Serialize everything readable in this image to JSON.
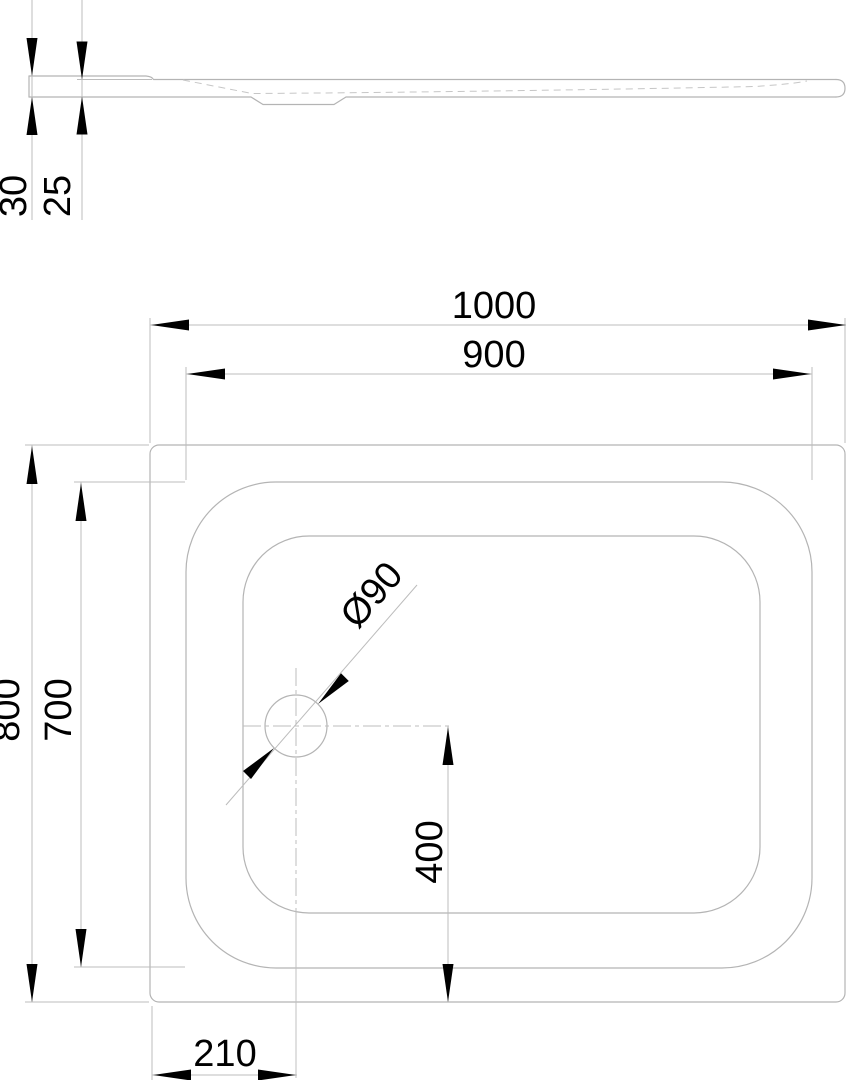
{
  "page": {
    "background": "#ffffff",
    "line_color": "#b4b4b4",
    "text_color": "#000000"
  },
  "drawing": {
    "kind": "shower-tray technical drawing, side profile and plan view",
    "views": {
      "side_profile": {
        "dimensions": {
          "edge_height": "30",
          "basin_depth": "25"
        }
      },
      "plan": {
        "dimensions": {
          "overall_width": "1000",
          "rim_width": "900",
          "overall_depth": "800",
          "rim_depth": "700",
          "drain_offset_bottom": "400",
          "drain_offset_left": "210",
          "drain_diameter": "Ø90"
        }
      }
    }
  }
}
